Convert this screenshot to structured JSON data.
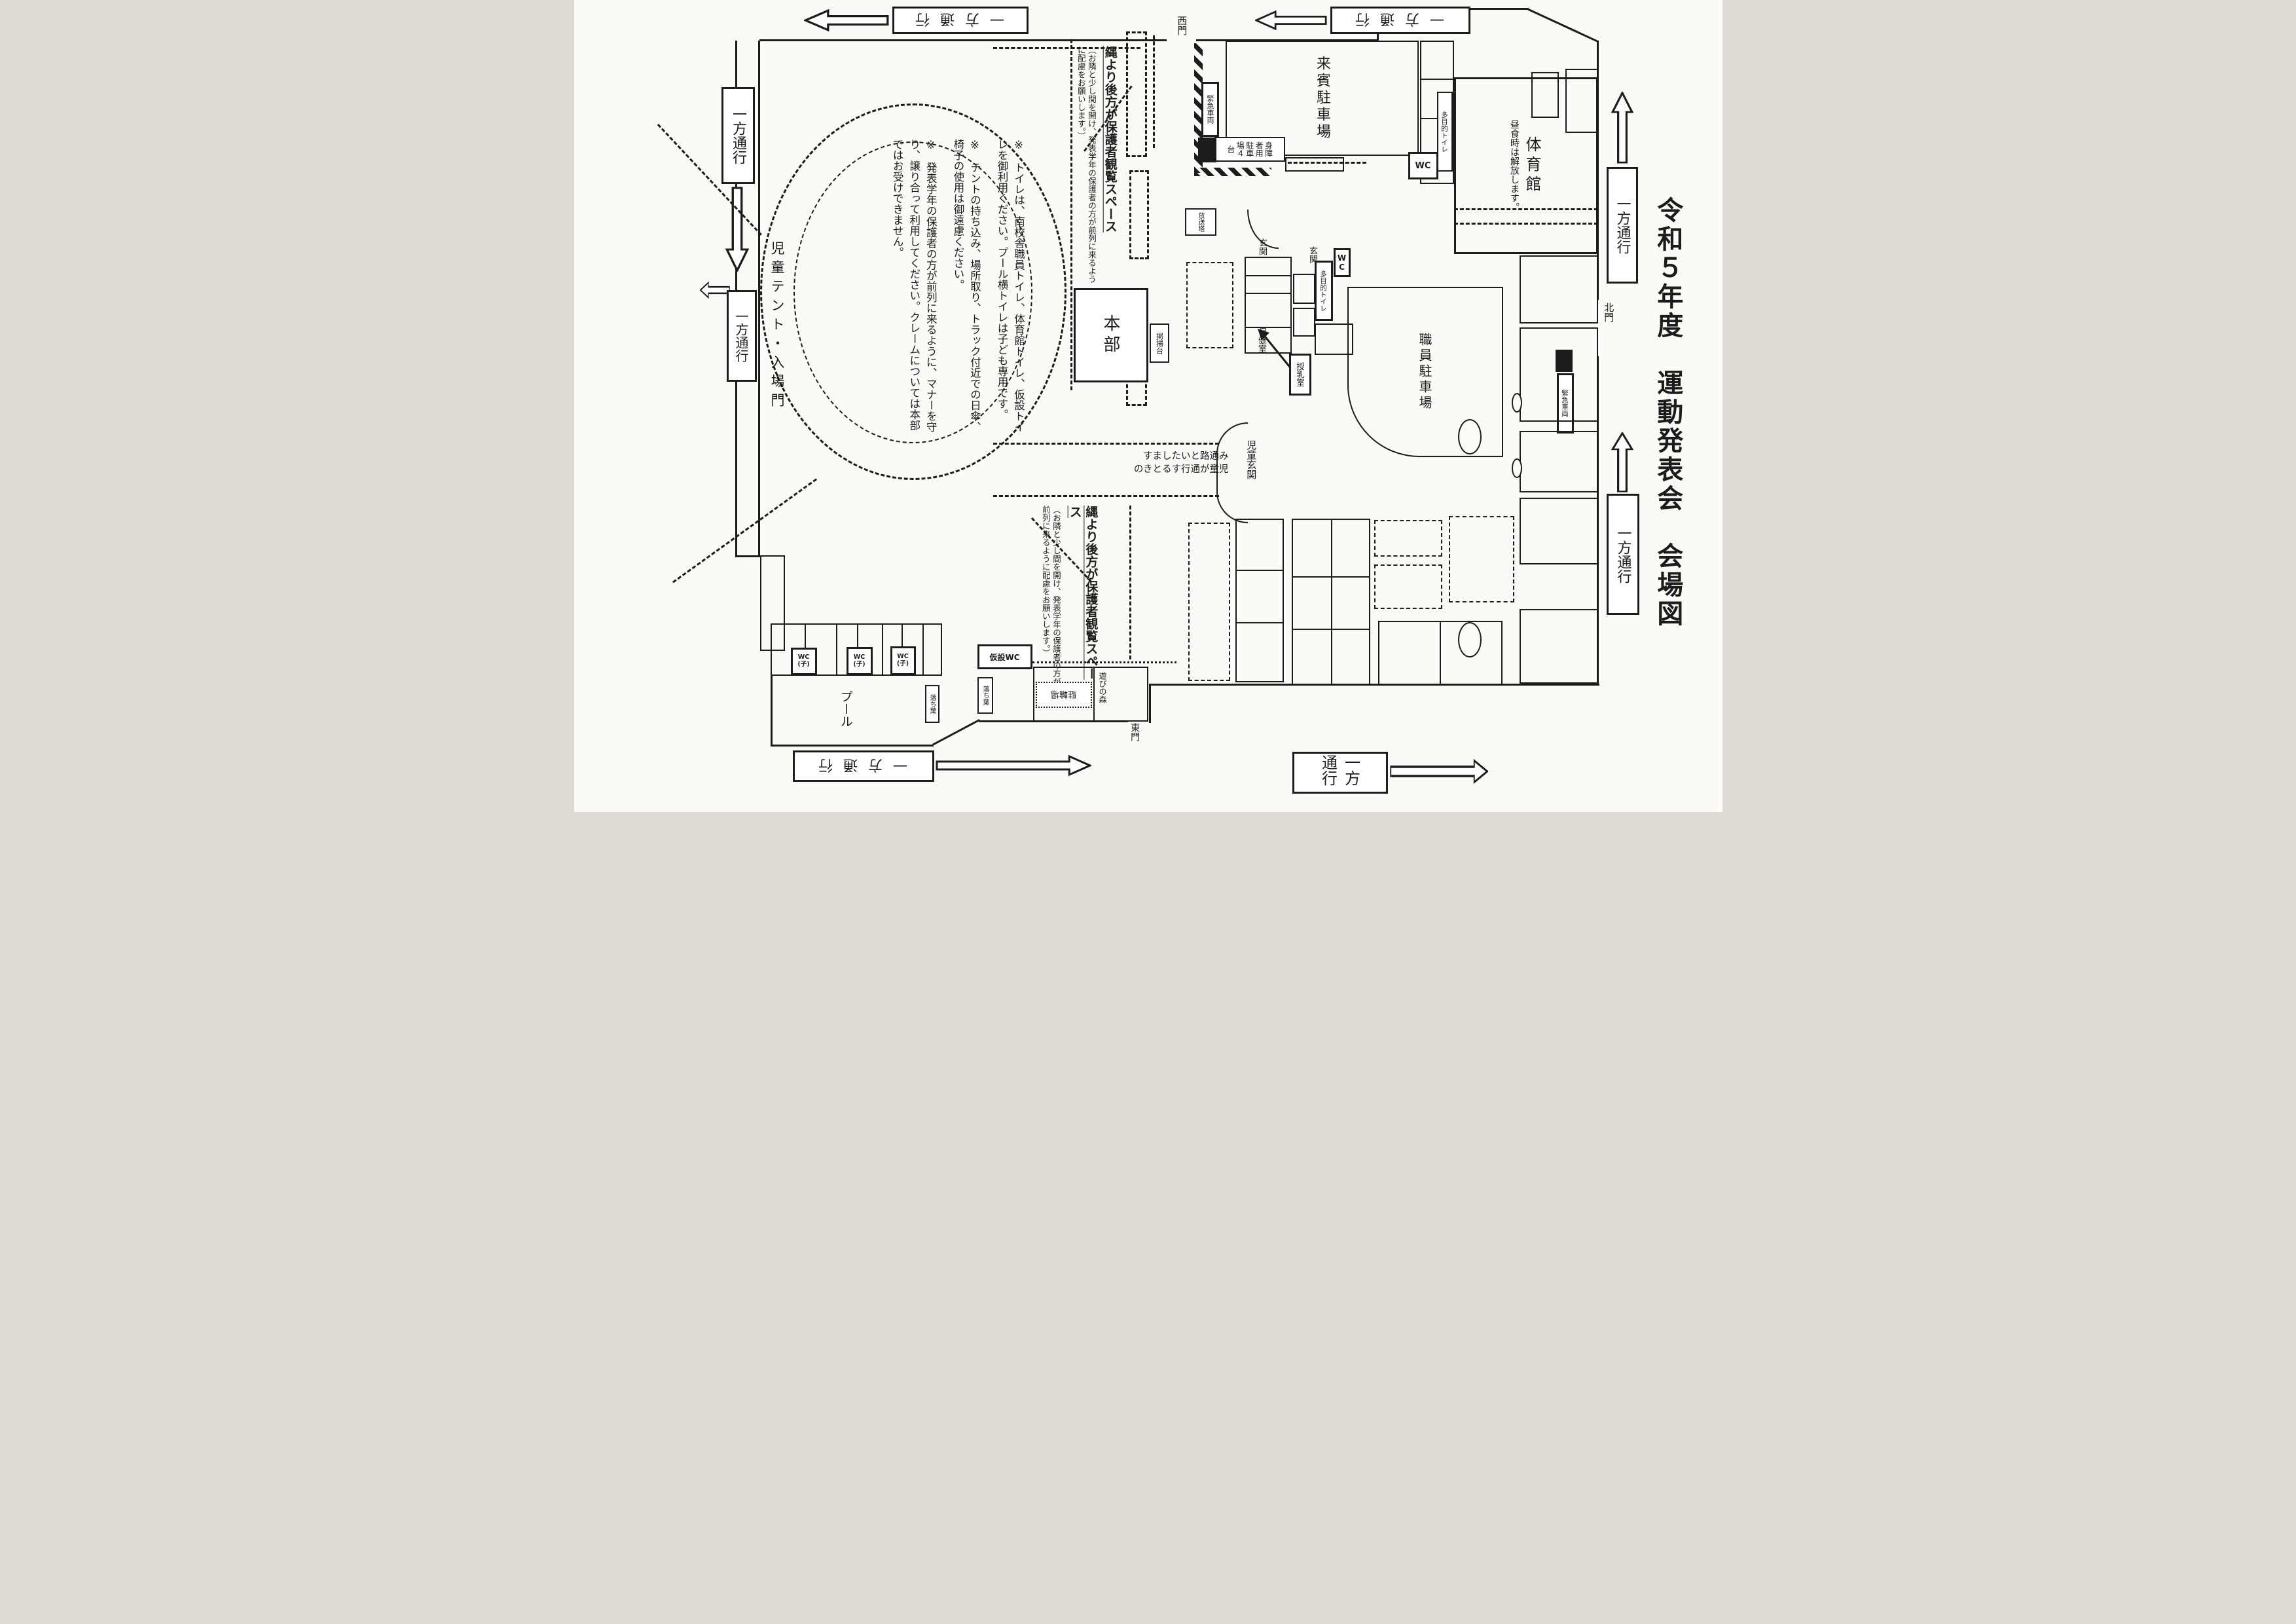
{
  "title": "令和５年度　運動発表会　会場図",
  "signs": {
    "one_way": "一方通行"
  },
  "gates": {
    "west": "西門",
    "north": "北門",
    "east": "東門"
  },
  "areas": {
    "guest_parking": "来賓駐車場",
    "gym": "体育館",
    "gym_note": "昼食時は解放します。",
    "multi_toilet": "多目的トイレ",
    "wc": "WC",
    "temp_wc": "仮設WC",
    "emergency_vehicle": "緊急車両",
    "disabled_parking": "身障者用駐車場４台",
    "broadcast_tower": "放送塔",
    "entrance": "玄関",
    "staff_parking": "職員駐車場",
    "health_room": "保健室",
    "nursing_room": "授乳室",
    "children_entrance": "児童玄関",
    "hq": "本部",
    "flag_stand": "掲揚台",
    "children_tent_gate": "児童テント・入場門",
    "pool": "プール",
    "fallen_leaves": "落ち葉",
    "bicycle_parking": "駐輪場",
    "play_forest": "遊びの森"
  },
  "wc_child": {
    "line1": "WC",
    "line2": "(子)"
  },
  "viewing_space": {
    "main": "縄より後方が保護者観覧スペース",
    "sub": "（お隣と少し間を開け、発表学年の保護者の方が前列に来るように配慮をお願いします。）"
  },
  "corridor_note": {
    "full": "児童が通行するときのみ通路といたします",
    "lines": [
      "すましたいと路通み",
      "のきとるす行通が童児"
    ]
  },
  "notes": [
    "※　トイレは、南校舎職員トイレ、体育館トイレ、仮設トイレを御利用ください。プール横トイレは子ども専用です。",
    "※　テントの持ち込み、場所取り、トラック付近での日傘、椅子の使用は御遠慮ください。",
    "※　発表学年の保護者の方が前列に来るように、マナーを守り、譲り合って利用してください。クレームについては本部ではお受けできません。"
  ]
}
